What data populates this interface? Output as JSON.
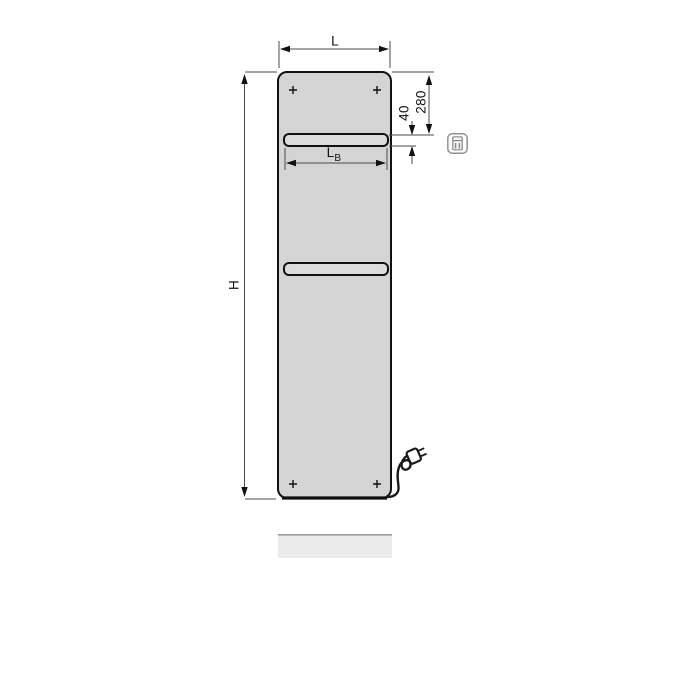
{
  "diagram": {
    "kind": "radiator-dimension-drawing",
    "labels": {
      "width": "L",
      "height": "H",
      "top_to_rail": "280",
      "rail_slot_height": "40",
      "rail_width_base": "L",
      "rail_width_sub": "B"
    },
    "icons": {
      "controller": "electric-controller-icon",
      "plug": "power-plug-icon",
      "mounting_marks": "plus-mark-icon"
    },
    "colors": {
      "background": "#ffffff",
      "panel_fill": "#d4d4d4",
      "slot_fill": "#dcdcdc",
      "panel_outline": "#111111",
      "dimension_line": "#4a4a4a",
      "arrow_fill": "#111111",
      "reflection_fill": "#ebebeb",
      "reflection_edge": "#9b9b9b",
      "icon_gray": "#8f8f8f",
      "cord_color": "#1a1a1a"
    }
  }
}
